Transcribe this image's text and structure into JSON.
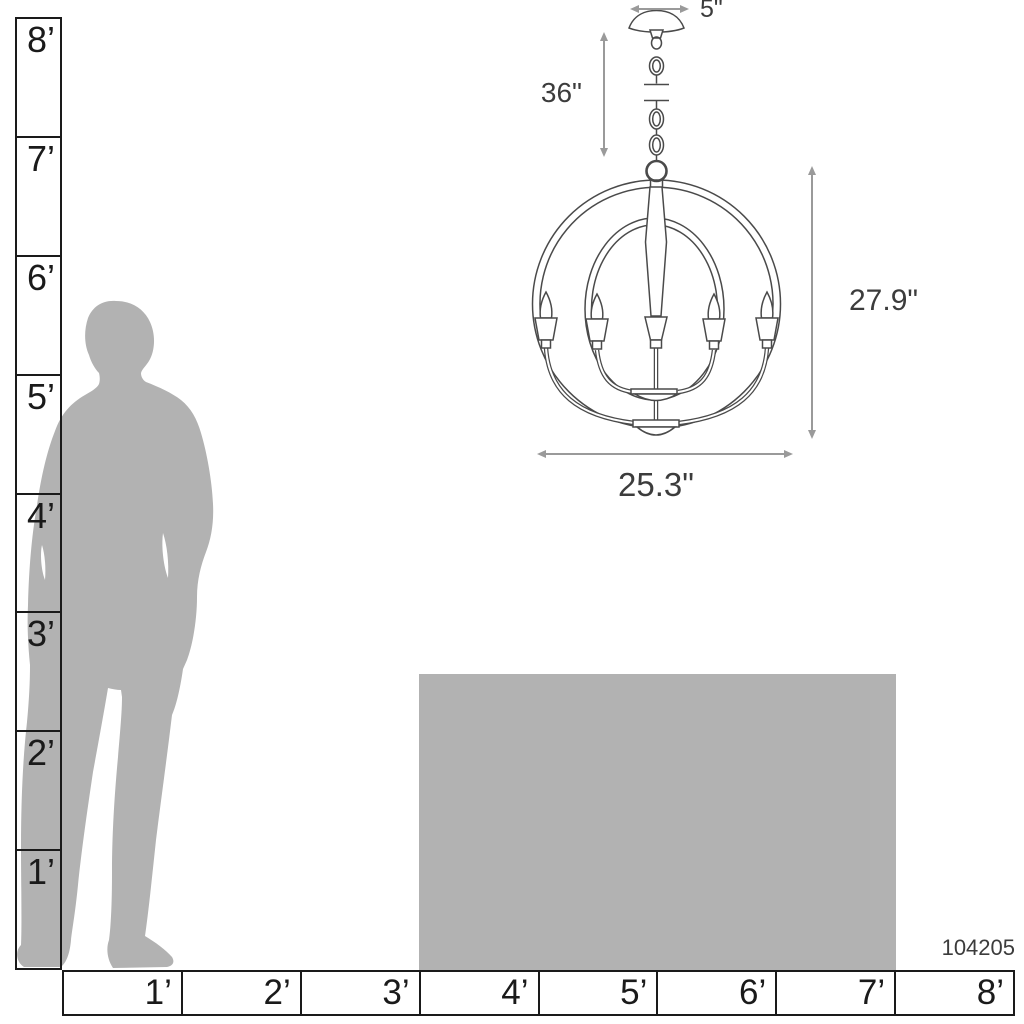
{
  "product_code": "104205",
  "dimensions": {
    "canopy_width": "5\"",
    "chain_length": "36\"",
    "fixture_height": "27.9\"",
    "fixture_width": "25.3\""
  },
  "vertical_ruler": {
    "labels": [
      "8’",
      "7’",
      "6’",
      "5’",
      "4’",
      "3’",
      "2’",
      "1’"
    ]
  },
  "horizontal_ruler": {
    "labels": [
      "1’",
      "2’",
      "3’",
      "4’",
      "5’",
      "6’",
      "7’",
      "8’"
    ]
  },
  "colors": {
    "silhouette_gray": "#b2b2b2",
    "table_gray": "#b2b2b2",
    "ruler_black": "#1a1a1a",
    "arrow_gray": "#9a9a9a",
    "dimension_text": "#3c3c3c",
    "line_art": "#4a4a4a"
  }
}
